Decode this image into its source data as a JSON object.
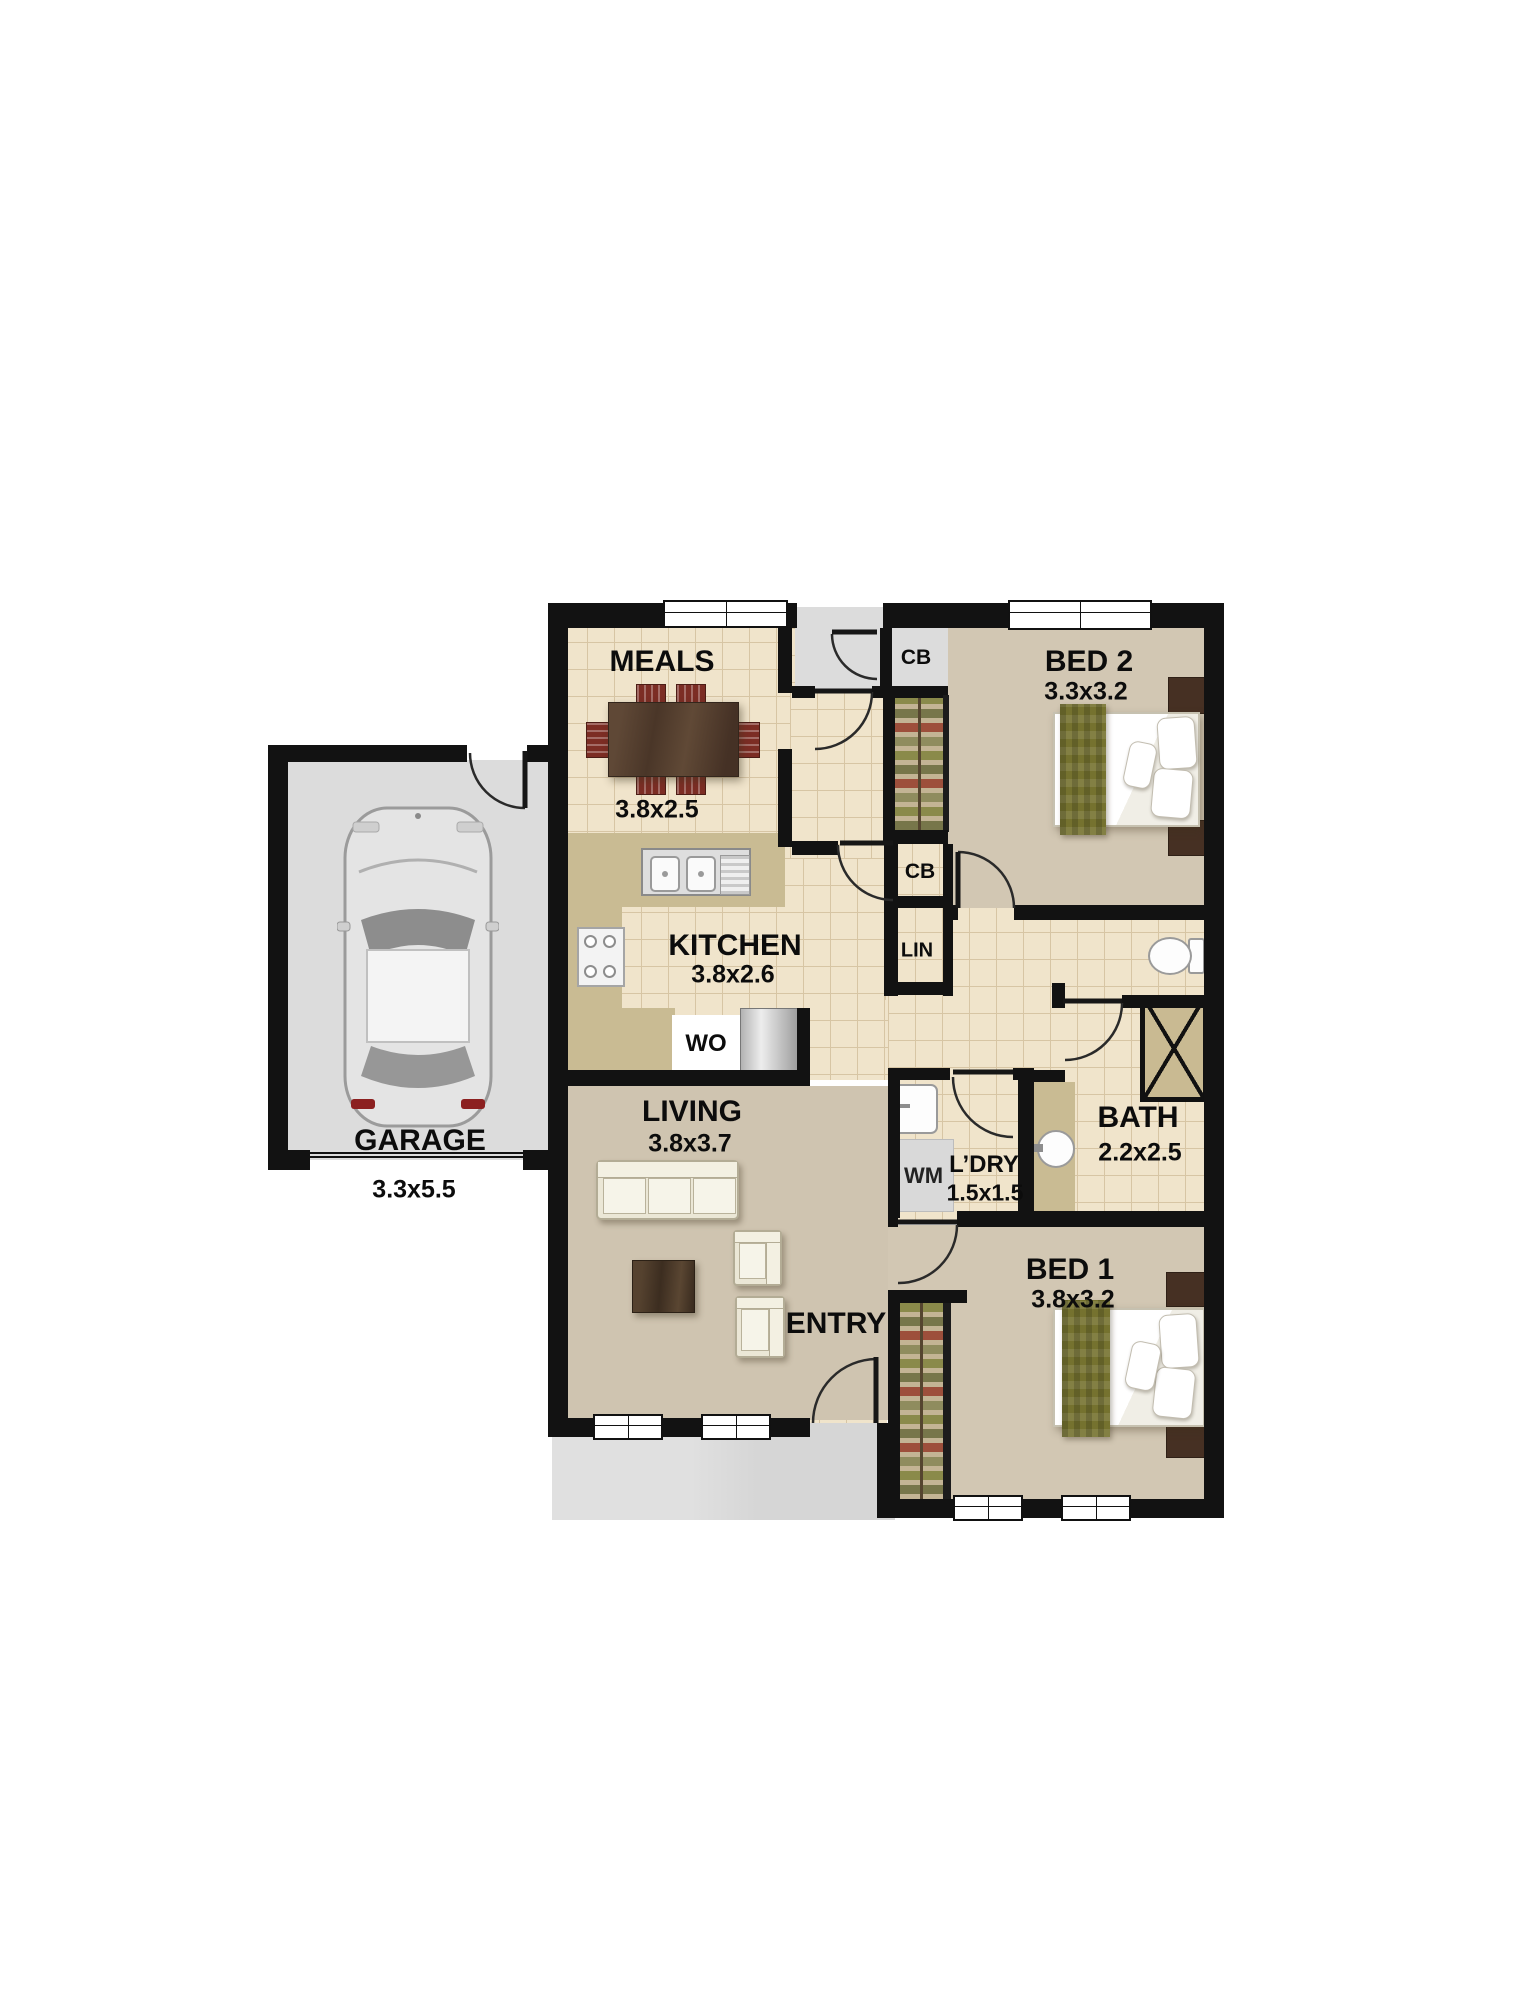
{
  "rooms": {
    "meals": {
      "name": "MEALS",
      "dims": "3.8x2.5"
    },
    "kitchen": {
      "name": "KITCHEN",
      "dims": "3.8x2.6"
    },
    "living": {
      "name": "LIVING",
      "dims": "3.8x3.7"
    },
    "bed2": {
      "name": "BED 2",
      "dims": "3.3x3.2"
    },
    "bed1": {
      "name": "BED 1",
      "dims": "3.8x3.2"
    },
    "bath": {
      "name": "BATH",
      "dims": "2.2x2.5"
    },
    "laundry": {
      "name": "L’DRY",
      "dims": "1.5x1.5"
    },
    "entry": {
      "name": "ENTRY"
    },
    "garage": {
      "name": "GARAGE",
      "dims": "3.3x5.5"
    }
  },
  "fixtures": {
    "cupboard_top": "CB",
    "cupboard_hall": "CB",
    "linen": "LIN",
    "washing_machine": "WM",
    "wall_oven": "WO"
  },
  "colors": {
    "wall": "#121212",
    "tile_floor": "#f0e4cb",
    "tile_grid": "#d7c5a4",
    "carpet": "#d2c7b3",
    "bench": "#c9bb93",
    "concrete": "#dcdcdc",
    "throw_green": "#75722f",
    "dining_wood": "#5a4433",
    "chair_red": "#7c2d24",
    "dark_wood": "#463023"
  }
}
